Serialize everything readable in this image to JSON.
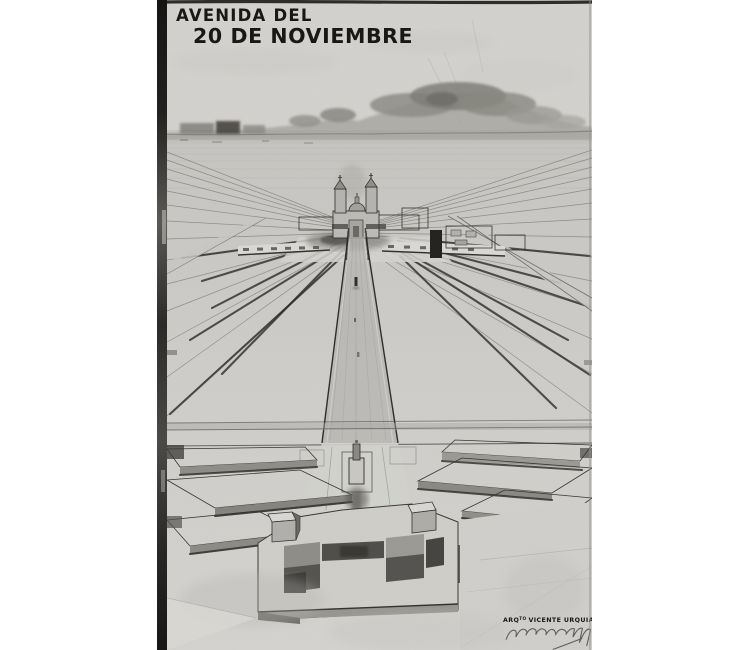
{
  "artwork": {
    "title": {
      "line1": "AVENIDA DEL",
      "line2": "20 DE NOVIEMBRE"
    },
    "credit": {
      "abbr": "ARQ",
      "abbr_sup": "TO",
      "name": "VICENTE URQUIAGA"
    },
    "colors": {
      "page_bg": "#ffffff",
      "paper": "#d3d2ce",
      "paper_dark": "#c7c6c2",
      "ink": "#171614",
      "wash_light": "#c2c1bd",
      "wash_mid": "#97968f",
      "wash_dark": "#54524d",
      "shadow_deep": "#2c2b28",
      "hill_wash": "#a3a29c",
      "film_edge": "#121110"
    }
  }
}
